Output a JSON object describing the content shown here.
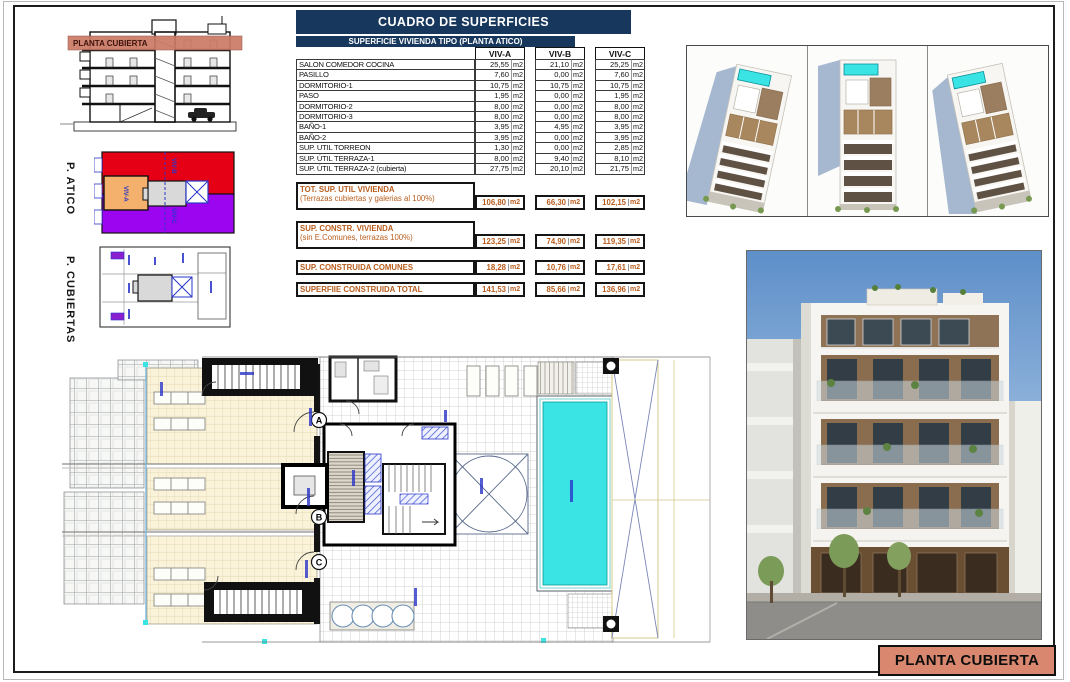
{
  "sheet": {
    "title_box": "PLANTA CUBIERTA"
  },
  "elevation": {
    "band_label": "PLANTA CUBIERTA"
  },
  "plans": {
    "atico": {
      "label": "P. ATICO",
      "regions": [
        "VIV-A",
        "VIV-B",
        "VIV-C"
      ]
    },
    "cubiertas": {
      "label": "P. CUBIERTAS"
    }
  },
  "table": {
    "title": "CUADRO DE SUPERFICIES",
    "subtitle": "SUPERFICIE VIVIENDA TIPO  (PLANTA ATICO)",
    "columns": [
      "VIV-A",
      "VIV-B",
      "VIV-C"
    ],
    "unit": "m2",
    "rows": [
      {
        "label": "SALON COMEDOR COCINA",
        "a": "25,55",
        "b": "21,10",
        "c": "25,25"
      },
      {
        "label": "PASILLO",
        "a": "7,60",
        "b": "0,00",
        "c": "7,60"
      },
      {
        "label": "DORMITORIO-1",
        "a": "10,75",
        "b": "10,75",
        "c": "10,75"
      },
      {
        "label": "PASO",
        "a": "1,95",
        "b": "0,00",
        "c": "1,95"
      },
      {
        "label": "DORMITORIO-2",
        "a": "8,00",
        "b": "0,00",
        "c": "8,00"
      },
      {
        "label": "DORMITORIO-3",
        "a": "8,00",
        "b": "0,00",
        "c": "8,00"
      },
      {
        "label": "BAÑO-1",
        "a": "3,95",
        "b": "4,95",
        "c": "3,95"
      },
      {
        "label": "BAÑO-2",
        "a": "3,95",
        "b": "0,00",
        "c": "3,95"
      },
      {
        "label": "SUP. UTIL TORREON",
        "a": "1,30",
        "b": "0,00",
        "c": "2,85"
      },
      {
        "label": "SUP. ÚTIL TERRAZA-1",
        "a": "8,00",
        "b": "9,40",
        "c": "8,10"
      },
      {
        "label": "SUP. ÚTIL TERRAZA-2 (cubierta)",
        "a": "27,75",
        "b": "20,10",
        "c": "21,75"
      }
    ],
    "totals": [
      {
        "label": "TOT. SUP. UTIL VIVIENDA",
        "sub": "(Terrazas cubiertas y galerias al 100%)",
        "a": "106,80",
        "b": "66,30",
        "c": "102,15"
      },
      {
        "label": "SUP. CONSTR. VIVIENDA",
        "sub": "(sin E.Comunes, terrazas 100%)",
        "a": "123,25",
        "b": "74,90",
        "c": "119,35"
      },
      {
        "label": "SUP. CONSTRUIDA COMUNES",
        "sub": "",
        "a": "18,28",
        "b": "10,76",
        "c": "17,61"
      },
      {
        "label": "SUPERFIIE CONSTRUIDA TOTAL",
        "sub": "",
        "a": "141,53",
        "b": "85,66",
        "c": "136,96"
      }
    ]
  },
  "floor_plan": {
    "markers": [
      "A",
      "B",
      "C"
    ]
  },
  "colors": {
    "header_navy": "#17375d",
    "total_orange": "#b85c1c",
    "band_red": "#cc7a66",
    "label_bg": "#d9886f",
    "atico_red": "#e60016",
    "atico_orange": "#f4b16d",
    "atico_purple": "#9c05ef",
    "pool_cyan": "#3ae4e4",
    "terrace_cream": "#faf3d9",
    "annotation_blue": "#2a35c8"
  }
}
